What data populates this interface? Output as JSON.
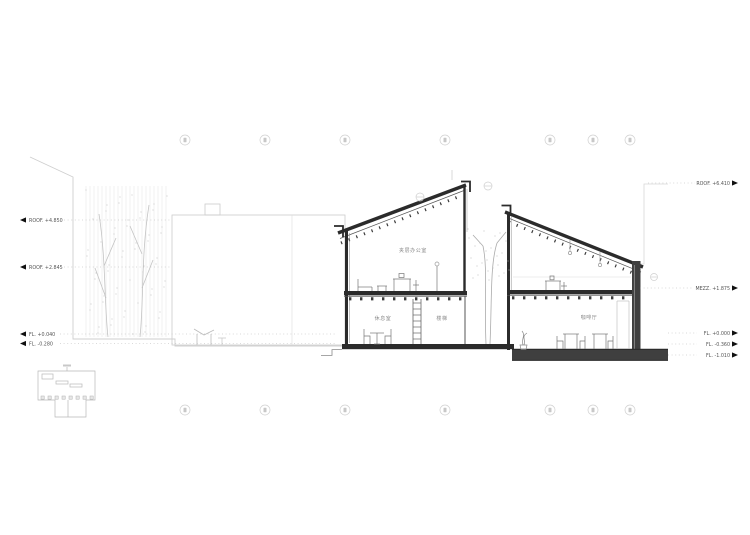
{
  "drawing_title": "building-section",
  "levels": {
    "left": [
      {
        "name": "roof-upper-left",
        "label": "ROOF. +4.850"
      },
      {
        "name": "roof-lower-left",
        "label": "ROOF. +2.845"
      },
      {
        "name": "fl-terrace-left",
        "label": "FL. +0.040"
      },
      {
        "name": "fl-garden-left",
        "label": "FL. -0.280"
      }
    ],
    "right": [
      {
        "name": "roof-right",
        "label": "ROOF. +6.410"
      },
      {
        "name": "mezz-right",
        "label": "MEZZ. +1.875"
      },
      {
        "name": "fl-zero",
        "label": "FL. +0.000"
      },
      {
        "name": "fl-minus360",
        "label": "FL. -0.360"
      },
      {
        "name": "fl-minus1010",
        "label": "FL. -1.010"
      }
    ]
  },
  "rooms": {
    "mezz_office": "夹层办公室",
    "lounge": "休息室",
    "stair": "楼梯",
    "cafe": "咖啡厅"
  },
  "grid": {
    "top_count": 7,
    "bottom_count": 7
  },
  "colors": {
    "ink": "#2b2b2b",
    "wall_fill": "#3f3f3f",
    "mid": "#666666",
    "light": "#c9c9c9",
    "faint": "#e6e6e6",
    "leader": "#aaaaaa",
    "paper": "#ffffff"
  }
}
